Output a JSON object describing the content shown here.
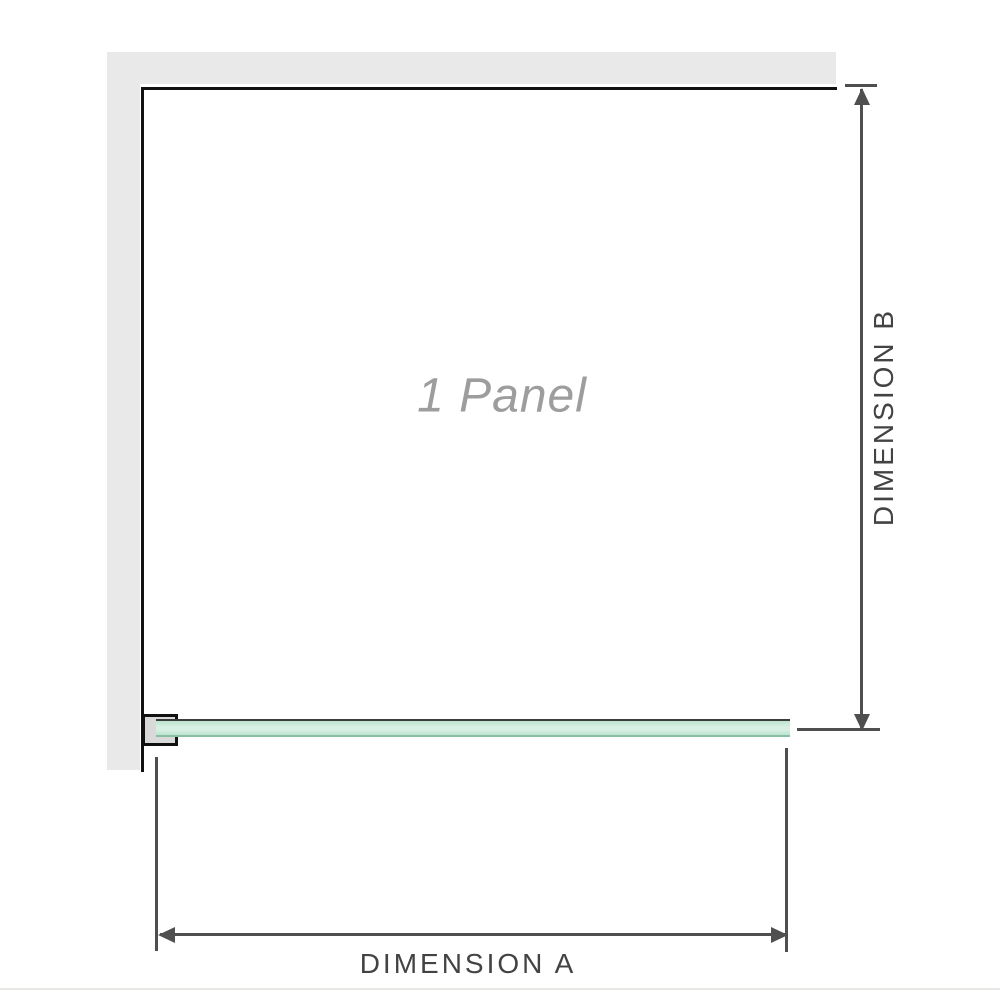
{
  "diagram": {
    "panel_label": "1 Panel",
    "dimension_a_label": "DIMENSION A",
    "dimension_b_label": "DIMENSION B",
    "icons": {
      "arrowhead_up": "triangle-up",
      "arrowhead_down": "triangle-down",
      "arrowhead_left": "triangle-left",
      "arrowhead_right": "triangle-right"
    },
    "colors": {
      "wall": "#e9e9e9",
      "frame": "#111111",
      "bracket_fill": "#d9d9d9",
      "glass_fill": "#bce4cf",
      "glass_highlight": "#d9f0e4",
      "glass_edge_top": "#3c3c3c",
      "glass_edge_bottom": "#88bfa3",
      "dimension": "#4f4f4f",
      "dim_text": "#434343",
      "label_gray": "#9d9d9d",
      "rule": "#e7e7e3"
    }
  }
}
